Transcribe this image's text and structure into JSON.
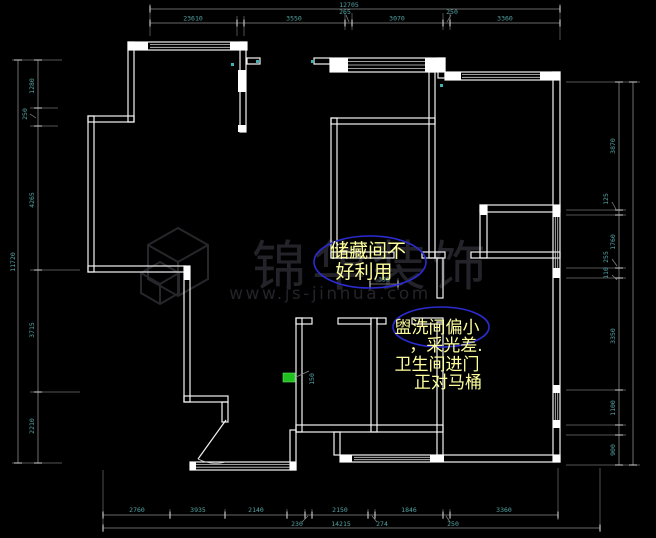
{
  "drawing": {
    "type": "cad-floor-plan",
    "colors": {
      "background": "#000000",
      "wall": "#f2f2f2",
      "dim_line": "#8a8a8a",
      "dim_text": "#55a3a3",
      "annotation_ellipse": "#2b2bd0",
      "annotation_text": "#ffff9e",
      "watermark": "#232329",
      "green_item": "#1fc11f"
    }
  },
  "dims": {
    "top": {
      "overall": "12705",
      "segments": [
        "23610",
        "3550",
        "265",
        "3070",
        "250",
        "3360"
      ]
    },
    "bottom": {
      "row1": [
        "2760",
        "3935",
        "2140",
        "2150",
        "1846",
        "3360"
      ],
      "row2": [
        "230",
        "274",
        "250"
      ],
      "overall": "14215"
    },
    "left": {
      "overall": "11720",
      "segments": [
        "1280",
        "250",
        "4265",
        "3715",
        "2210"
      ]
    },
    "right": {
      "segments": [
        "3870",
        "125",
        "1760",
        "255",
        "110",
        "3350",
        "1100",
        "900"
      ]
    },
    "inner": {
      "storage_door": "350",
      "green_label": "150"
    }
  },
  "annotations": {
    "storage": {
      "lines": [
        "储藏间不",
        "好利用"
      ]
    },
    "bath": {
      "lines": [
        "盥洗间偏小",
        "，采光差.",
        "卫生间进门",
        "正对马桶"
      ]
    }
  },
  "watermark": {
    "brand": "锦华装饰",
    "url": "www.js-jinhua.com"
  }
}
